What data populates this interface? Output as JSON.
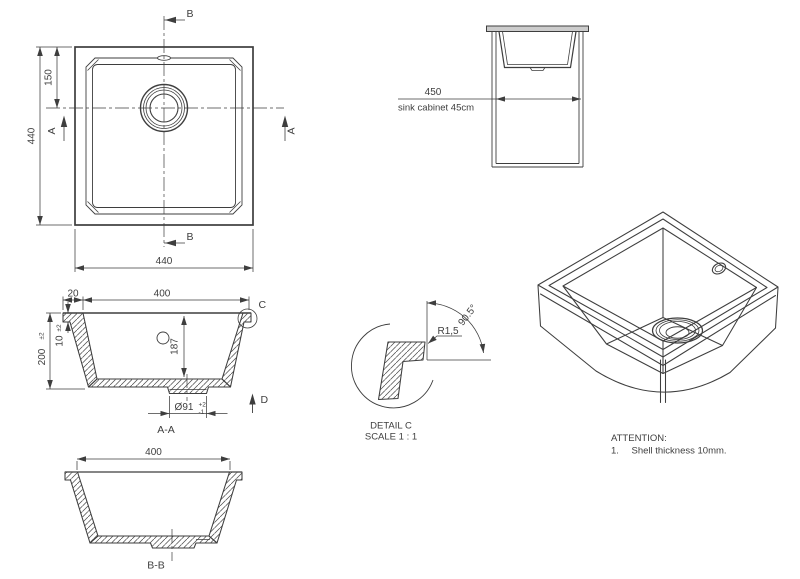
{
  "colors": {
    "line": "#3e3e3e",
    "background": "#ffffff",
    "countertop_fill": "#cccccc"
  },
  "plan": {
    "section_b": "B",
    "section_a": "A",
    "dim_overall_width": "440",
    "dim_overall_height": "440",
    "dim_drain_from_top": "150"
  },
  "cabinet": {
    "dim_width": "450",
    "caption": "sink cabinet 45cm"
  },
  "section_aa": {
    "label": "A-A",
    "dim_rim": "20",
    "dim_inner_width": "400",
    "dim_height": "200",
    "dim_height_tol": "±2",
    "dim_shell": "10",
    "dim_shell_tol": "±2",
    "dim_inner_depth": "187",
    "dim_drain_dia": "Ø91",
    "dim_drain_tol_plus": "+2",
    "dim_drain_tol_minus": "-1",
    "detail_marker": "C",
    "view_marker": "D"
  },
  "detail_c": {
    "label": "DETAIL C",
    "scale": "SCALE 1 : 1",
    "radius": "R1,5",
    "angle": "90.5°"
  },
  "section_bb": {
    "label": "B-B",
    "dim_inner_width": "400"
  },
  "attention": {
    "title": "ATTENTION:",
    "item_number": "1.",
    "item_text": "Shell thickness 10mm."
  }
}
